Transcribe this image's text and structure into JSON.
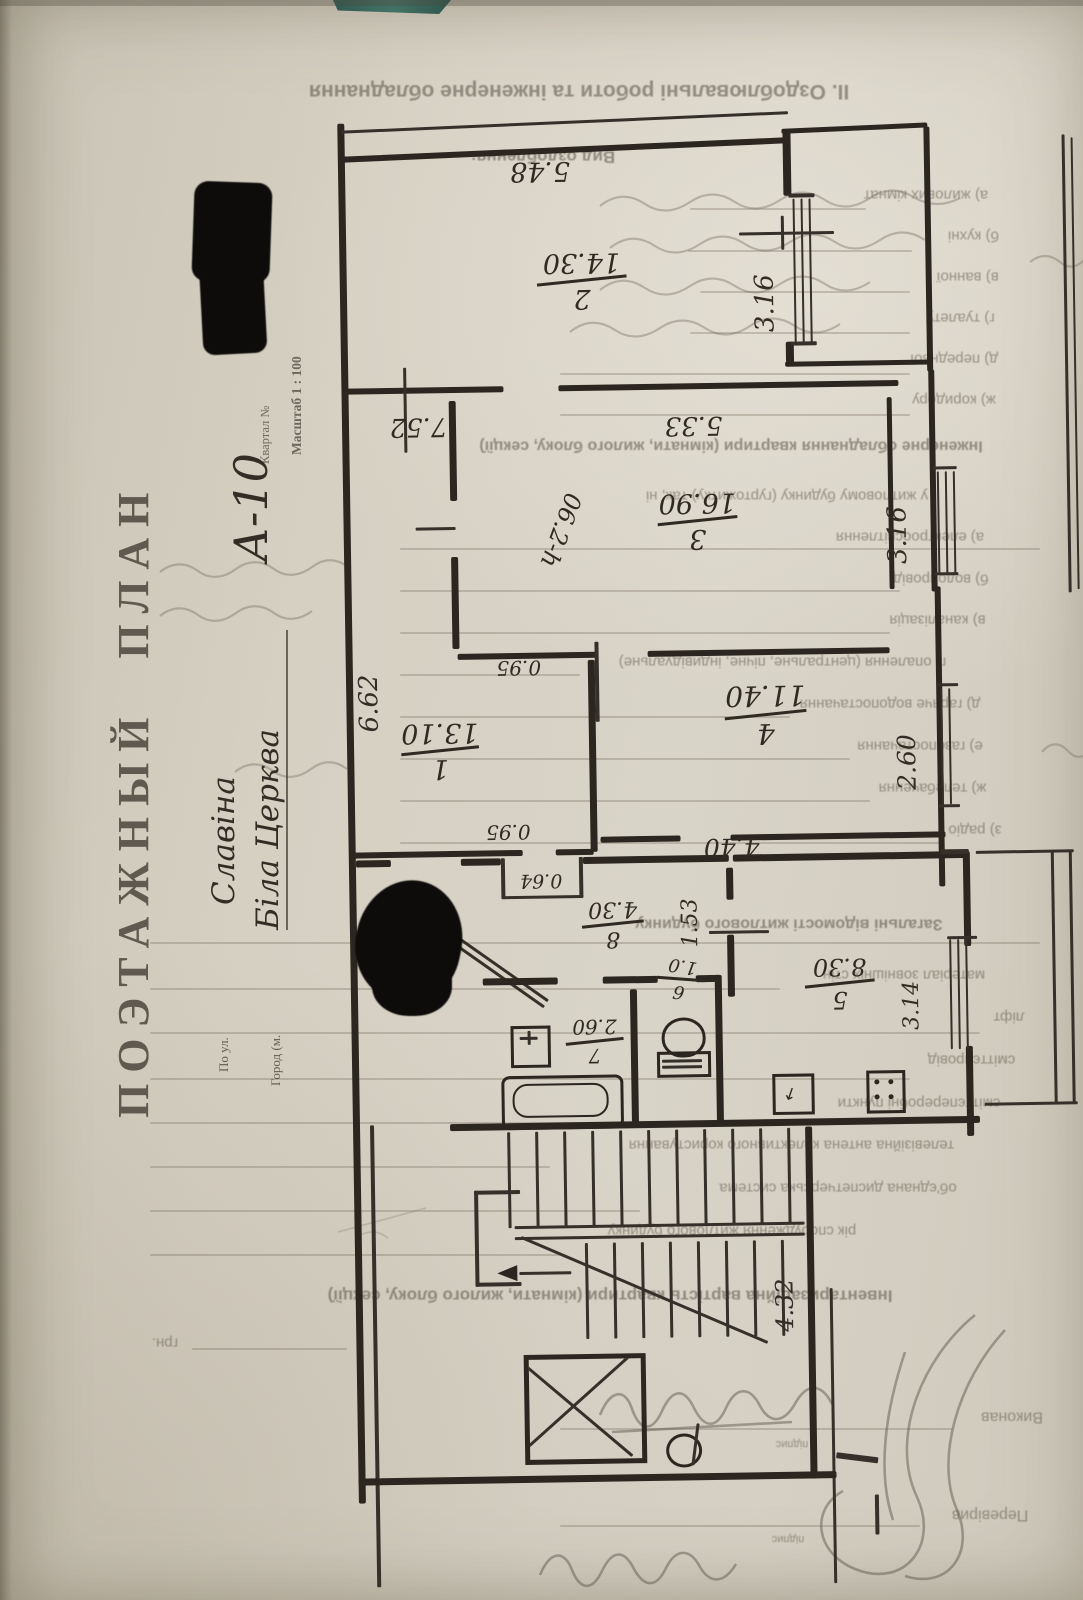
{
  "document": {
    "stamp_title": "ПОЭТАЖНЫЙ ПЛАН",
    "kvartal_label": "Квартал №",
    "scale_label": "Масштаб 1 : 100",
    "street_label": "По ул.",
    "city_label": "Город (м.",
    "handwritten": {
      "building": "А-10",
      "street": "Славіна",
      "city": "Біла Церква"
    }
  },
  "ghost": {
    "header": "ІІ. Оздоблювальні роботи та інженерне обладнання",
    "vid": "Вид оздоблення:",
    "a": "а) жилових кімнат",
    "b": "б) кухні",
    "c": "в) ванної",
    "d": "г) туалету",
    "e": "д) передньої",
    "f": "ж) коридору",
    "eng": "Інженерне обладнання квартири (кімнати, жилого блоку, секції)",
    "eng2": "у житловому будинку (гуртожитку) так, ні",
    "i1": "а) електроосвітлення",
    "i2": "б) водопровід",
    "i3": "в) каналізація",
    "i4": "г) опалення (центральне, пічне, індивідуальне)",
    "i5": "д) гаряче водопостачання",
    "i6": "е) газопостачання",
    "i7": "ж) телебачення",
    "i8": "з) радіо",
    "gen": "Загальні відомості житлового будинку",
    "g1": "матеріал зовнішніх стін",
    "g2": "ліфт",
    "g3": "сміттєпровід",
    "g4": "сміттєпереробні пункти",
    "g5": "телевізійна антена колективного користування",
    "g6": "об'єднана диспетчерська система",
    "g7": "рік спорудження житлового будинку",
    "inv": "Інвентаризаційна вартість квартири (кімнати, жилого блоку, секції)",
    "grn": "грн.",
    "done_by": "Виконав",
    "sign": "підпис",
    "checked_by": "Перевірив"
  },
  "plan": {
    "rooms": [
      {
        "n": "1",
        "area": "13.10"
      },
      {
        "n": "2",
        "area": "14.30"
      },
      {
        "n": "3",
        "area": "16.90"
      },
      {
        "n": "4",
        "area": "11.40"
      },
      {
        "n": "5",
        "area": "8.30"
      },
      {
        "n": "6",
        "area": "1.0"
      },
      {
        "n": "7",
        "area": "2.60"
      },
      {
        "n": "8",
        "area": "4.30"
      }
    ],
    "dims": {
      "d548": "5.48",
      "d316a": "3.16",
      "d316b": "3.16",
      "d752": "7.52",
      "d533": "5.33",
      "h260": "h-2.60",
      "d662": "6.62",
      "d095a": "0.95",
      "d095b": "0.95",
      "d260": "2.60",
      "d440": "4.40",
      "d064": "0.64",
      "d153": "1.53",
      "d314": "3.14",
      "d432": "4.32"
    }
  }
}
